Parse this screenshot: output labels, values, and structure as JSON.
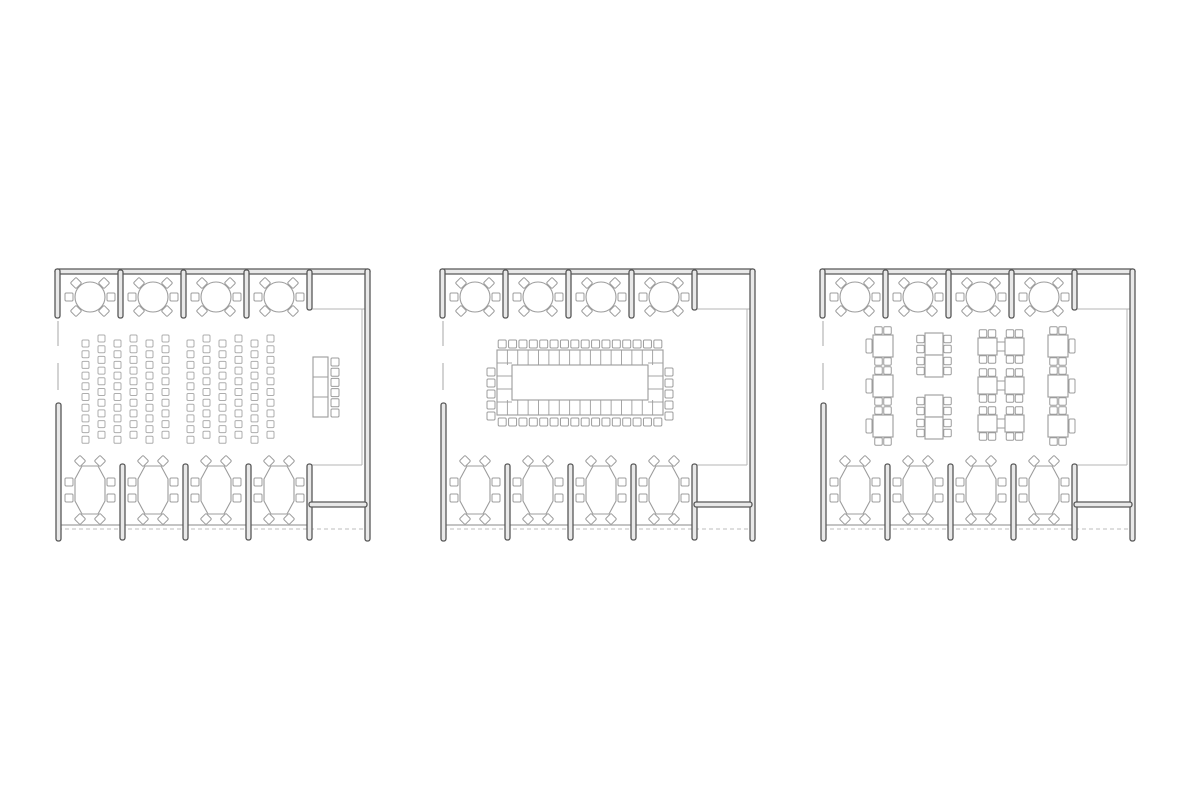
{
  "canvas": {
    "width": 1200,
    "height": 800,
    "background": "#ffffff"
  },
  "colors": {
    "wall": "#585858",
    "wall_fill": "#e9e9e9",
    "furniture": "#9c9c9c",
    "furniture_light": "#adadad",
    "thin": "#b5b5b5",
    "baseline": "#b0b0b0",
    "dashed": "#c9c9c9",
    "white": "#ffffff"
  },
  "plan_box": {
    "w": 325,
    "h": 278
  },
  "shell": {
    "walls": [
      {
        "name": "top-wall",
        "x": 7,
        "y": 1,
        "w": 315,
        "h": 5
      },
      {
        "name": "left-corner-return",
        "x": 7,
        "y": 1,
        "w": 5,
        "h": 49
      },
      {
        "name": "top-partition-1",
        "x": 70,
        "y": 2,
        "w": 5,
        "h": 48
      },
      {
        "name": "top-partition-2",
        "x": 133,
        "y": 2,
        "w": 5,
        "h": 48
      },
      {
        "name": "top-partition-3",
        "x": 196,
        "y": 2,
        "w": 5,
        "h": 48
      },
      {
        "name": "top-partition-4",
        "x": 259,
        "y": 2,
        "w": 5,
        "h": 40
      },
      {
        "name": "right-wall",
        "x": 317,
        "y": 1,
        "w": 5,
        "h": 272
      },
      {
        "name": "left-bottom-stub",
        "x": 8,
        "y": 135,
        "w": 5,
        "h": 138
      },
      {
        "name": "bottom-partition-1",
        "x": 72,
        "y": 196,
        "w": 5,
        "h": 76
      },
      {
        "name": "bottom-partition-2",
        "x": 135,
        "y": 196,
        "w": 5,
        "h": 76
      },
      {
        "name": "bottom-partition-3",
        "x": 198,
        "y": 196,
        "w": 5,
        "h": 76
      },
      {
        "name": "stair-left-wall",
        "x": 259,
        "y": 196,
        "w": 5,
        "h": 76
      },
      {
        "name": "stair-cross-wall",
        "x": 261,
        "y": 234,
        "w": 58,
        "h": 5
      }
    ],
    "thin_lines": [
      {
        "name": "alcove-niche-line",
        "x1": 264,
        "y1": 41,
        "x2": 317,
        "y2": 41,
        "w": 1
      },
      {
        "name": "right-inner-face",
        "x1": 314,
        "y1": 41,
        "x2": 314,
        "y2": 197,
        "w": 1
      },
      {
        "name": "stair-top-line",
        "x1": 261,
        "y1": 197,
        "x2": 314,
        "y2": 197,
        "w": 1
      },
      {
        "name": "left-window-1",
        "x1": 10,
        "y1": 53,
        "x2": 10,
        "y2": 78,
        "w": 1.2
      },
      {
        "name": "left-window-2",
        "x1": 10,
        "y1": 95,
        "x2": 10,
        "y2": 122,
        "w": 1.2
      },
      {
        "name": "bottom-baseline",
        "x1": 10,
        "y1": 257,
        "x2": 259,
        "y2": 257,
        "w": 1.6
      }
    ],
    "dashed_lines": [
      {
        "name": "bottom-dashed-line",
        "x1": 10,
        "y1": 261,
        "x2": 320,
        "y2": 261
      }
    ]
  },
  "perimeter": {
    "round_tables": {
      "centers_x": [
        42,
        105,
        168,
        231
      ],
      "cy": 29,
      "r": 15,
      "chair_size": 8,
      "chairs": [
        {
          "dx": -14,
          "dy": -14,
          "d": 1
        },
        {
          "dx": 14,
          "dy": -14,
          "d": 1
        },
        {
          "dx": -21,
          "dy": 0,
          "d": 0
        },
        {
          "dx": 21,
          "dy": 0,
          "d": 0
        },
        {
          "dx": -14,
          "dy": 14,
          "d": 1
        },
        {
          "dx": 14,
          "dy": 14,
          "d": 1
        }
      ]
    },
    "oval_tables": {
      "centers_x": [
        42,
        105,
        168,
        231
      ],
      "cy": 222,
      "chair_size": 8,
      "poly": [
        [
          -8,
          -24
        ],
        [
          8,
          -24
        ],
        [
          15,
          -11
        ],
        [
          15,
          11
        ],
        [
          8,
          24
        ],
        [
          -8,
          24
        ],
        [
          -15,
          11
        ],
        [
          -15,
          -11
        ]
      ],
      "chairs": [
        {
          "dx": -10,
          "dy": -29,
          "d": 1
        },
        {
          "dx": 10,
          "dy": -29,
          "d": 1
        },
        {
          "dx": -21,
          "dy": -8,
          "d": 0
        },
        {
          "dx": 21,
          "dy": -8,
          "d": 0
        },
        {
          "dx": -21,
          "dy": 8,
          "d": 0
        },
        {
          "dx": 21,
          "dy": 8,
          "d": 0
        },
        {
          "dx": -10,
          "dy": 29,
          "d": 1
        },
        {
          "dx": 10,
          "dy": 29,
          "d": 1
        }
      ]
    },
    "seats_top_alcoves": 24,
    "seats_bottom_bays": 32
  },
  "plans": [
    {
      "key": "theater",
      "label": "floor plan - theater row seating with head table",
      "origin": {
        "x": 48,
        "y": 268
      },
      "arrangement": "theater",
      "seat_counts": {
        "rows": 120,
        "head_table": 6,
        "top_alcoves": 24,
        "bottom_bays": 32
      },
      "theater": {
        "banks": [
          34,
          139
        ],
        "cols": 6,
        "col_spacing": 16,
        "rows": 10,
        "row_spacing": 10.7,
        "chair": 7,
        "start_y": 72,
        "stagger": 5
      },
      "head_table": {
        "x": 265,
        "y": 89,
        "w": 15,
        "h": 60,
        "cells": 3,
        "chairs": {
          "x": 283,
          "y0": 94,
          "spacing": 10.2,
          "count": 6,
          "size": 8
        }
      }
    },
    {
      "key": "boardroom",
      "label": "floor plan - hollow square boardroom table",
      "origin": {
        "x": 433,
        "y": 268
      },
      "arrangement": "boardroom",
      "seat_counts": {
        "board_table": 42,
        "top_alcoves": 24,
        "bottom_bays": 32
      },
      "boardroom": {
        "outer": {
          "x": 64,
          "y": 82,
          "w": 166,
          "h": 65
        },
        "inner": {
          "x": 79,
          "y": 97,
          "w": 136,
          "h": 35
        },
        "cells_h": 16,
        "cells_v": 5,
        "top_chairs": {
          "count": 16,
          "cx0": 69.2,
          "spacing": 10.375,
          "cy": 76,
          "size": 8
        },
        "bottom_chairs": {
          "count": 16,
          "cx0": 69.2,
          "spacing": 10.375,
          "cy": 154,
          "size": 8
        },
        "left_chairs": {
          "count": 5,
          "cx": 58,
          "cy0": 104,
          "spacing": 11,
          "size": 8
        },
        "right_chairs": {
          "count": 5,
          "cx": 236,
          "cy0": 104,
          "spacing": 11,
          "size": 8
        }
      }
    },
    {
      "key": "clusters",
      "label": "floor plan - cafe table clusters",
      "origin": {
        "x": 813,
        "y": 268
      },
      "arrangement": "clusters",
      "seat_counts": {
        "clusters": 70,
        "top_alcoves": 24,
        "bottom_bays": 32
      },
      "clusters": {
        "square": {
          "w": 20,
          "h": 22
        },
        "vtable": {
          "w": 18,
          "h": 22
        },
        "htable": {
          "w": 19,
          "h": 17,
          "gap": 27
        },
        "side_chair": {
          "w": 6,
          "h": 14
        },
        "chair": 7.5,
        "items": [
          {
            "t": "sqL",
            "x": 60,
            "y": 67
          },
          {
            "t": "sqL",
            "x": 60,
            "y": 107
          },
          {
            "t": "sqL",
            "x": 60,
            "y": 147
          },
          {
            "t": "vp",
            "x": 112,
            "y": 65
          },
          {
            "t": "vp",
            "x": 112,
            "y": 127
          },
          {
            "t": "hp",
            "x": 165,
            "y": 70
          },
          {
            "t": "hp",
            "x": 165,
            "y": 109
          },
          {
            "t": "hp",
            "x": 165,
            "y": 147
          },
          {
            "t": "sqR",
            "x": 235,
            "y": 67
          },
          {
            "t": "sqR",
            "x": 235,
            "y": 107
          },
          {
            "t": "sqR",
            "x": 235,
            "y": 147
          }
        ]
      }
    }
  ]
}
